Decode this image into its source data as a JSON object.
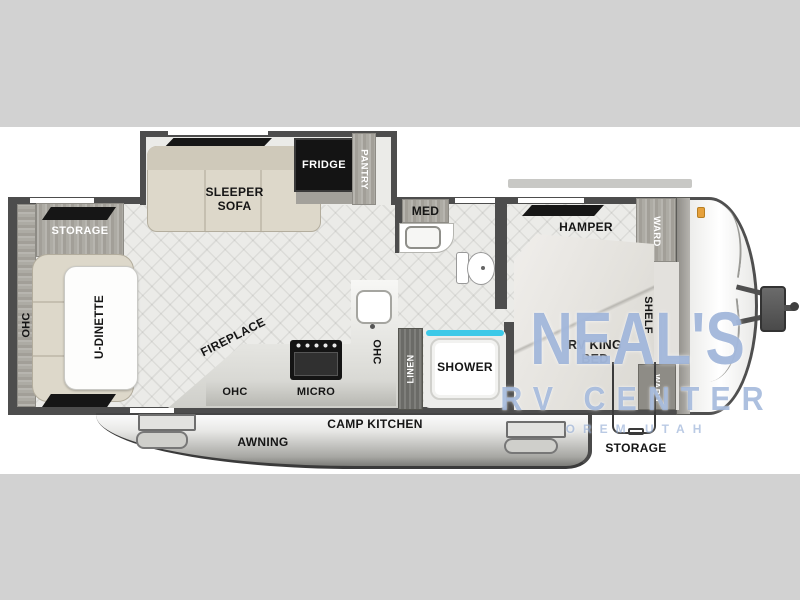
{
  "watermark": {
    "name": "NEAL'S",
    "line2": "RV CENTER",
    "line3": "OREM UTAH"
  },
  "labels": {
    "rear_storage": "STORAGE",
    "rear_ohc": "OHC",
    "u_dinette": "U-DINETTE",
    "sleeper_sofa": "SLEEPER\nSOFA",
    "fridge": "FRIDGE",
    "pantry": "PANTRY",
    "med": "MED",
    "fireplace": "FIREPLACE",
    "kitchen_ohc": "OHC",
    "micro": "MICRO",
    "counter_ohc": "OHC",
    "linen": "LINEN",
    "shower": "SHOWER",
    "camp_kitchen": "CAMP KITCHEN",
    "awning": "AWNING",
    "front_storage": "STORAGE",
    "hamper": "HAMPER",
    "ward_upper": "WARD",
    "ward_lower": "WARD",
    "rv_king_bed": "RV KING\nBED",
    "shelf": "SHELF"
  },
  "colors": {
    "background": "#d2d2d2",
    "canvas": "#ffffff",
    "wall": "#4d4d4d",
    "watermark_blue": "#6a8cc4",
    "shower_glass": "#3cc9e8",
    "marker_light": "#e6a13c"
  }
}
